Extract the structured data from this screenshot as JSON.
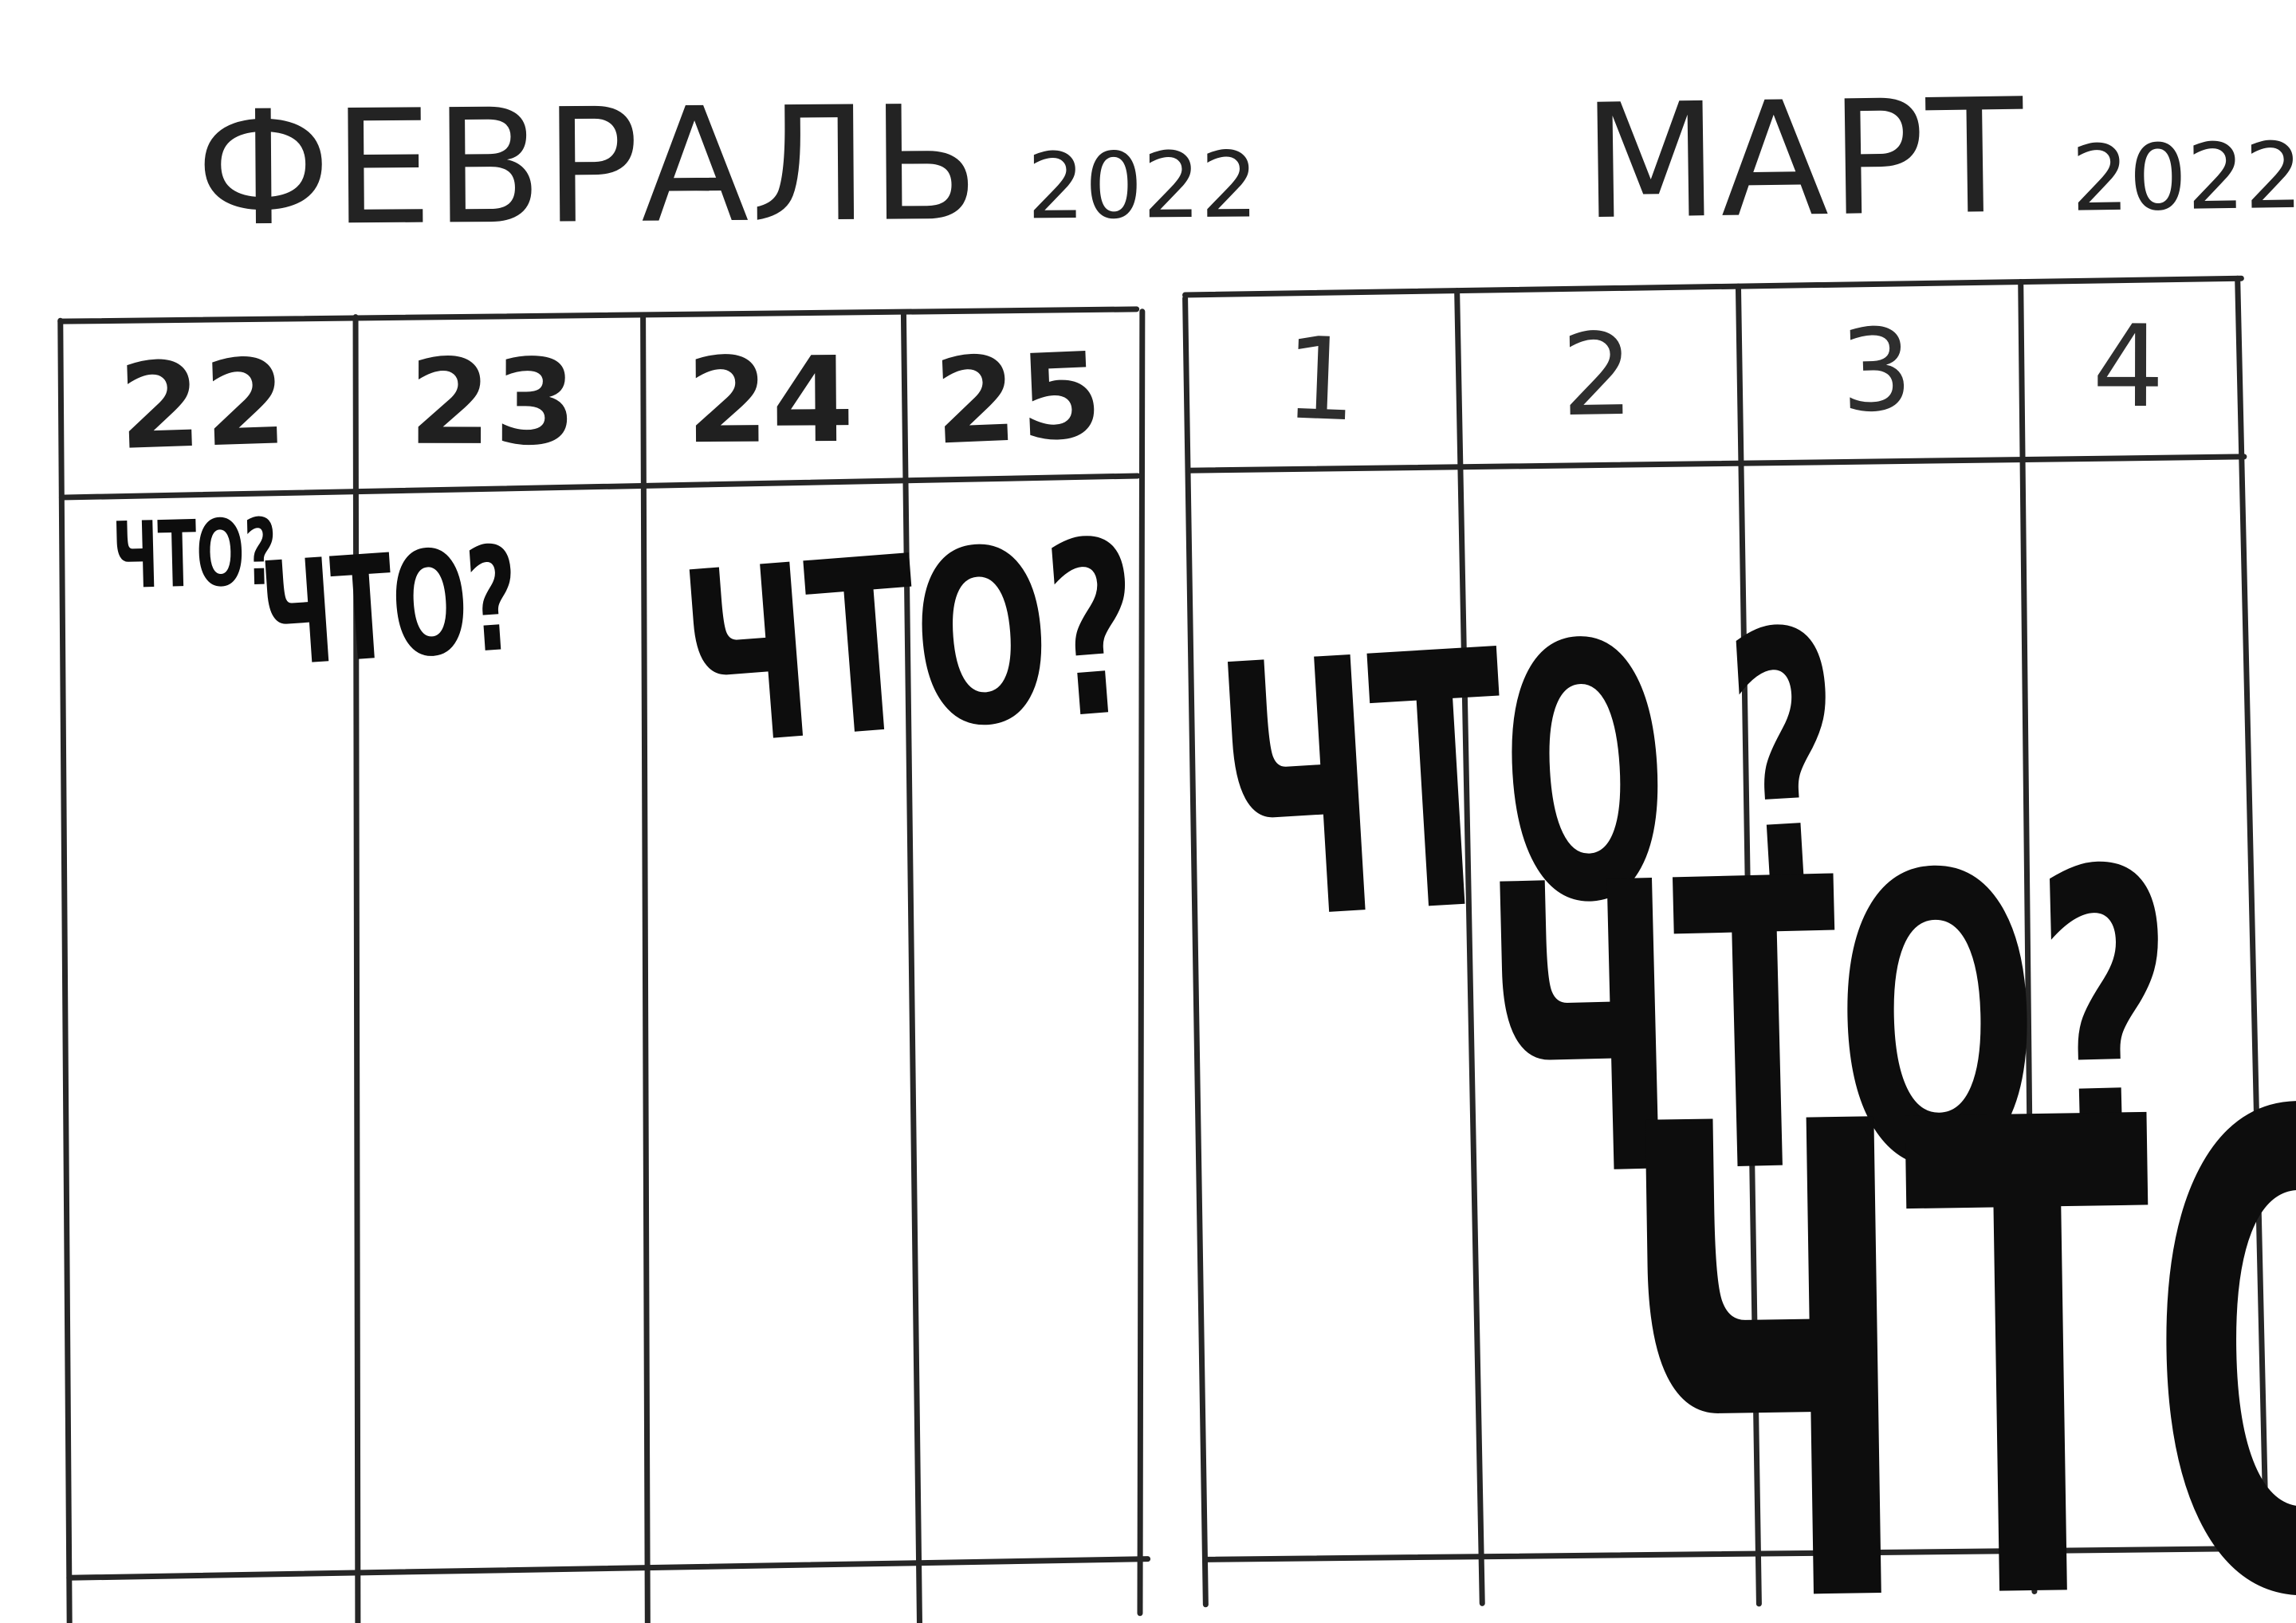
{
  "colors": {
    "paper": "#ffffff",
    "ink": "#262626",
    "marker": "#0d0d0d"
  },
  "calendars": [
    {
      "name": "february",
      "title": "ФЕВРАЛЬ",
      "year": "2022",
      "days": [
        "22",
        "23",
        "24",
        "25"
      ],
      "entries": [
        {
          "day": "22",
          "text": "ЧТО?"
        },
        {
          "day": "23",
          "text": "ЧТО?"
        },
        {
          "day": "24",
          "text": "ЧТО?"
        }
      ]
    },
    {
      "name": "march",
      "title": "МАРТ",
      "year": "2022",
      "days": [
        "1",
        "2",
        "3",
        "4"
      ],
      "entries": [
        {
          "day": "1",
          "text": "ЧТО ?"
        },
        {
          "day": "2",
          "text": "ЧТО?"
        },
        {
          "day": "3",
          "text": "ЧТО"
        }
      ]
    }
  ]
}
